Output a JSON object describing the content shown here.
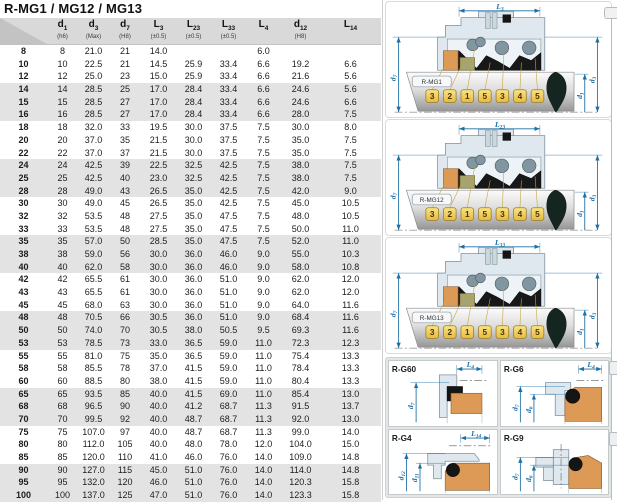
{
  "title": "R-MG1 / MG12 / MG13",
  "colors": {
    "dimension_blue": "#1e6fa5",
    "tag_yellow": "#f4cf5a",
    "seat_orange": "#dd9a57",
    "part_olive": "#a5a36e",
    "housing_blue_gray": "#dfe8ee",
    "row_stripe_gray": "#e3e3e3",
    "header_gray": "#d9d9d9"
  },
  "table": {
    "columns": [
      {
        "sym": "d",
        "idx": "1",
        "tol": "(h6)"
      },
      {
        "sym": "d",
        "idx": "3",
        "tol": "(Max)"
      },
      {
        "sym": "d",
        "idx": "7",
        "tol": "(H8)"
      },
      {
        "sym": "L",
        "idx": "3",
        "tol": "(±0.5)"
      },
      {
        "sym": "L",
        "idx": "23",
        "tol": "(±0.5)"
      },
      {
        "sym": "L",
        "idx": "33",
        "tol": "(±0.5)"
      },
      {
        "sym": "L",
        "idx": "4",
        "tol": ""
      },
      {
        "sym": "d",
        "idx": "12",
        "tol": "(H8)"
      },
      {
        "sym": "L",
        "idx": "14",
        "tol": ""
      }
    ],
    "rows": [
      [
        "8",
        "8",
        "21.0",
        "21",
        "14.0",
        "",
        "",
        "6.0",
        "",
        ""
      ],
      [
        "10",
        "10",
        "22.5",
        "21",
        "14.5",
        "25.9",
        "33.4",
        "6.6",
        "19.2",
        "6.6"
      ],
      [
        "12",
        "12",
        "25.0",
        "23",
        "15.0",
        "25.9",
        "33.4",
        "6.6",
        "21.6",
        "5.6"
      ],
      [
        "14",
        "14",
        "28.5",
        "25",
        "17.0",
        "28.4",
        "33.4",
        "6.6",
        "24.6",
        "5.6"
      ],
      [
        "15",
        "15",
        "28.5",
        "27",
        "17.0",
        "28.4",
        "33.4",
        "6.6",
        "24.6",
        "6.6"
      ],
      [
        "16",
        "16",
        "28.5",
        "27",
        "17.0",
        "28.4",
        "33.4",
        "6.6",
        "28.0",
        "7.5"
      ],
      [
        "18",
        "18",
        "32.0",
        "33",
        "19.5",
        "30.0",
        "37.5",
        "7.5",
        "30.0",
        "8.0"
      ],
      [
        "20",
        "20",
        "37.0",
        "35",
        "21.5",
        "30.0",
        "37.5",
        "7.5",
        "35.0",
        "7.5"
      ],
      [
        "22",
        "22",
        "37.0",
        "37",
        "21.5",
        "30.0",
        "37.5",
        "7.5",
        "35.0",
        "7.5"
      ],
      [
        "24",
        "24",
        "42.5",
        "39",
        "22.5",
        "32.5",
        "42.5",
        "7.5",
        "38.0",
        "7.5"
      ],
      [
        "25",
        "25",
        "42.5",
        "40",
        "23.0",
        "32.5",
        "42.5",
        "7.5",
        "38.0",
        "7.5"
      ],
      [
        "28",
        "28",
        "49.0",
        "43",
        "26.5",
        "35.0",
        "42.5",
        "7.5",
        "42.0",
        "9.0"
      ],
      [
        "30",
        "30",
        "49.0",
        "45",
        "26.5",
        "35.0",
        "42.5",
        "7.5",
        "45.0",
        "10.5"
      ],
      [
        "32",
        "32",
        "53.5",
        "48",
        "27.5",
        "35.0",
        "47.5",
        "7.5",
        "48.0",
        "10.5"
      ],
      [
        "33",
        "33",
        "53.5",
        "48",
        "27.5",
        "35.0",
        "47.5",
        "7.5",
        "50.0",
        "11.0"
      ],
      [
        "35",
        "35",
        "57.0",
        "50",
        "28.5",
        "35.0",
        "47.5",
        "7.5",
        "52.0",
        "11.0"
      ],
      [
        "38",
        "38",
        "59.0",
        "56",
        "30.0",
        "36.0",
        "46.0",
        "9.0",
        "55.0",
        "10.3"
      ],
      [
        "40",
        "40",
        "62.0",
        "58",
        "30.0",
        "36.0",
        "46.0",
        "9.0",
        "58.0",
        "10.8"
      ],
      [
        "42",
        "42",
        "65.5",
        "61",
        "30.0",
        "36.0",
        "51.0",
        "9.0",
        "62.0",
        "12.0"
      ],
      [
        "43",
        "43",
        "65.5",
        "61",
        "30.0",
        "36.0",
        "51.0",
        "9.0",
        "62.0",
        "12.0"
      ],
      [
        "45",
        "45",
        "68.0",
        "63",
        "30.0",
        "36.0",
        "51.0",
        "9.0",
        "64.0",
        "11.6"
      ],
      [
        "48",
        "48",
        "70.5",
        "66",
        "30.5",
        "36.0",
        "51.0",
        "9.0",
        "68.4",
        "11.6"
      ],
      [
        "50",
        "50",
        "74.0",
        "70",
        "30.5",
        "38.0",
        "50.5",
        "9.5",
        "69.3",
        "11.6"
      ],
      [
        "53",
        "53",
        "78.5",
        "73",
        "33.0",
        "36.5",
        "59.0",
        "11.0",
        "72.3",
        "12.3"
      ],
      [
        "55",
        "55",
        "81.0",
        "75",
        "35.0",
        "36.5",
        "59.0",
        "11.0",
        "75.4",
        "13.3"
      ],
      [
        "58",
        "58",
        "85.5",
        "78",
        "37.0",
        "41.5",
        "59.0",
        "11.0",
        "78.4",
        "13.3"
      ],
      [
        "60",
        "60",
        "88.5",
        "80",
        "38.0",
        "41.5",
        "59.0",
        "11.0",
        "80.4",
        "13.3"
      ],
      [
        "65",
        "65",
        "93.5",
        "85",
        "40.0",
        "41.5",
        "69.0",
        "11.0",
        "85.4",
        "13.0"
      ],
      [
        "68",
        "68",
        "96.5",
        "90",
        "40.0",
        "41.2",
        "68.7",
        "11.3",
        "91.5",
        "13.7"
      ],
      [
        "70",
        "70",
        "99.5",
        "92",
        "40.0",
        "48.7",
        "68.7",
        "11.3",
        "92.0",
        "13.0"
      ],
      [
        "75",
        "75",
        "107.0",
        "97",
        "40.0",
        "48.7",
        "68.7",
        "11.3",
        "99.0",
        "14.0"
      ],
      [
        "80",
        "80",
        "112.0",
        "105",
        "40.0",
        "48.0",
        "78.0",
        "12.0",
        "104.0",
        "15.0"
      ],
      [
        "85",
        "85",
        "120.0",
        "110",
        "41.0",
        "46.0",
        "76.0",
        "14.0",
        "109.0",
        "14.8"
      ],
      [
        "90",
        "90",
        "127.0",
        "115",
        "45.0",
        "51.0",
        "76.0",
        "14.0",
        "114.0",
        "14.8"
      ],
      [
        "95",
        "95",
        "132.0",
        "120",
        "46.0",
        "51.0",
        "76.0",
        "14.0",
        "120.3",
        "15.8"
      ],
      [
        "100",
        "100",
        "137.0",
        "125",
        "47.0",
        "51.0",
        "76.0",
        "14.0",
        "123.3",
        "15.8"
      ]
    ]
  },
  "diagrams": [
    {
      "label": "R-MG1",
      "dim_top_sym": "L",
      "dim_top_idx": "3",
      "dim_left_sym": "d",
      "dim_left_idx": "7",
      "dim_right1_sym": "d",
      "dim_right1_idx": "1",
      "dim_right2_sym": "d",
      "dim_right2_idx": "3",
      "tags": [
        "3",
        "2",
        "1",
        "5",
        "3",
        "4",
        "5"
      ]
    },
    {
      "label": "R-MG12",
      "dim_top_sym": "L",
      "dim_top_idx": "23",
      "dim_left_sym": "d",
      "dim_left_idx": "7",
      "dim_right1_sym": "d",
      "dim_right1_idx": "1",
      "dim_right2_sym": "d",
      "dim_right2_idx": "3",
      "tags": [
        "3",
        "2",
        "1",
        "5",
        "3",
        "4",
        "5"
      ]
    },
    {
      "label": "R-MG13",
      "dim_top_sym": "L",
      "dim_top_idx": "33",
      "dim_left_sym": "d",
      "dim_left_idx": "7",
      "dim_right1_sym": "d",
      "dim_right1_idx": "1",
      "dim_right2_sym": "d",
      "dim_right2_idx": "3",
      "tags": [
        "3",
        "2",
        "1",
        "5",
        "3",
        "4",
        "5"
      ]
    }
  ],
  "detail_panels": [
    {
      "label": "R-G60",
      "top_sym": "L",
      "top_idx": "4",
      "left1_sym": "d",
      "left1_idx": "7"
    },
    {
      "label": "R-G6",
      "top_sym": "L",
      "top_idx": "4",
      "left1_sym": "d",
      "left1_idx": "7",
      "left2_sym": "d",
      "left2_idx": "6"
    },
    {
      "label": "R-G4",
      "top_sym": "L",
      "top_idx": "14",
      "left1_sym": "d",
      "left1_idx": "12",
      "left2_sym": "d",
      "left2_idx": "11"
    },
    {
      "label": "R-G9",
      "left1_sym": "d",
      "left1_idx": "7",
      "left2_sym": "d",
      "left2_idx": "6"
    }
  ]
}
